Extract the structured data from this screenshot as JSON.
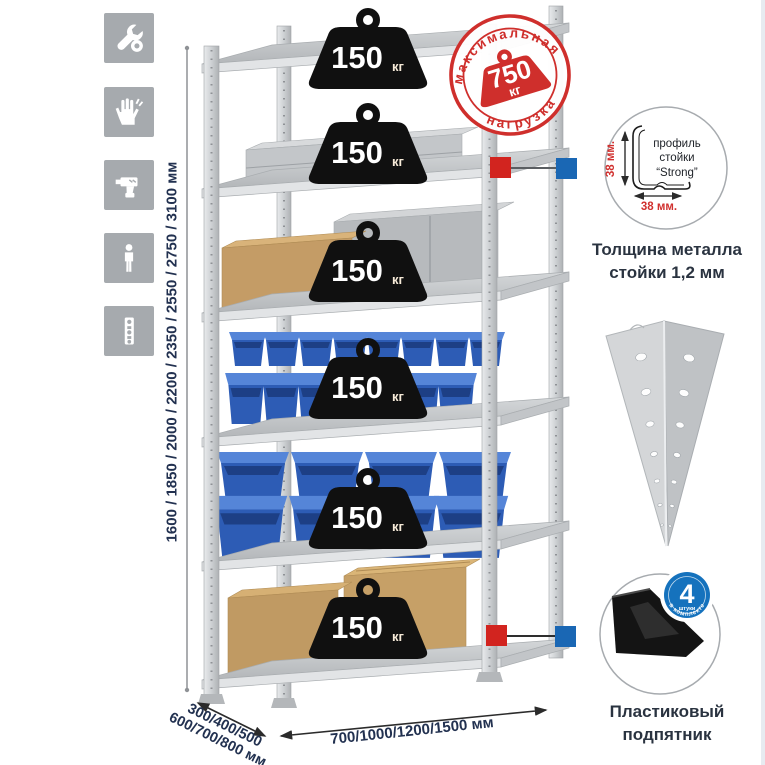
{
  "sidebar": {
    "icons": [
      {
        "name": "wrench"
      },
      {
        "name": "gloves"
      },
      {
        "name": "drill"
      },
      {
        "name": "person"
      },
      {
        "name": "perforated-post"
      }
    ]
  },
  "rack": {
    "load_unit": "кг",
    "shelves": [
      {
        "load": "150"
      },
      {
        "load": "150"
      },
      {
        "load": "150"
      },
      {
        "load": "150"
      },
      {
        "load": "150"
      },
      {
        "load": "150"
      }
    ]
  },
  "max_load_badge": {
    "arc_top": "максимальная",
    "arc_bottom": "нагрузка",
    "value": "750",
    "unit": "кг"
  },
  "profile_detail": {
    "line1": "профиль",
    "line2": "стойки",
    "line3": "“Strong”",
    "dim_vertical": "38 мм.",
    "dim_horizontal": "38 мм.",
    "caption1": "Толщина металла",
    "caption2": "стойки 1,2 мм"
  },
  "foot_detail": {
    "caption1": "Пластиковый",
    "caption2": "подпятник",
    "badge_value": "4",
    "badge_sub": "штуки",
    "badge_ring": "в комплекте"
  },
  "dimensions": {
    "height": "1600 / 1850 / 2000 / 2200 / 2350 / 2550 / 2750 / 3100 мм",
    "depth1": "300/400/500",
    "depth2": "600/700/800 мм",
    "width": "700/1000/1200/1500 мм"
  },
  "colors": {
    "accent_red": "#cf2f2c",
    "accent_blue": "#1572bd",
    "metal": "#c9ccce",
    "navy_text": "#223150"
  }
}
